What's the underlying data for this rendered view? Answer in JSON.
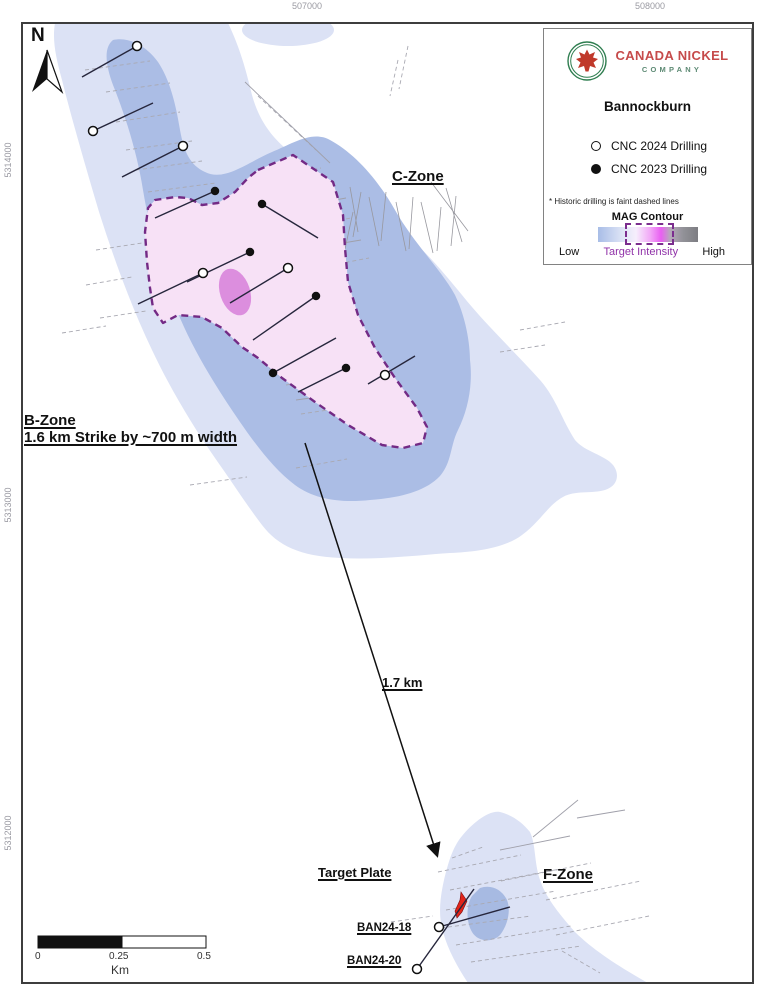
{
  "axes": {
    "top": [
      {
        "label": "507000",
        "x": 307
      },
      {
        "label": "508000",
        "x": 650
      }
    ],
    "left": [
      {
        "label": "5314000",
        "y": 160
      },
      {
        "label": "5313000",
        "y": 505
      },
      {
        "label": "5312000",
        "y": 833
      }
    ]
  },
  "legend": {
    "company_line1": "CANADA NICKEL",
    "company_line2": "COMPANY",
    "project": "Bannockburn",
    "item_2024": "CNC 2024 Drilling",
    "item_2023": "CNC 2023 Drilling",
    "note": "* Historic drilling is faint dashed lines",
    "mag_title": "MAG Contour",
    "mag_low": "Low",
    "mag_target": "Target Intensity",
    "mag_high": "High"
  },
  "labels": {
    "north": "N",
    "c_zone": "C-Zone",
    "b_zone_line1": "B-Zone",
    "b_zone_line2": "1.6 km Strike by ~700 m width",
    "distance": "1.7 km",
    "target_plate": "Target Plate",
    "f_zone": "F-Zone",
    "ban24_18": "BAN24-18",
    "ban24_20": "BAN24-20"
  },
  "scalebar": {
    "t0": "0",
    "t1": "0.25",
    "t2": "0.5",
    "unit": "Km"
  },
  "colors": {
    "mag_low_fill": "#dce2f5",
    "mag_mid_fill": "#abbde5",
    "target_fill": "#f7e1f6",
    "target_outline": "#732a85",
    "target_core": "#d77fd9",
    "plate_red": "#e1251b",
    "brand_red": "#c64b4b",
    "brand_green": "#2e7d4f"
  },
  "map_data": {
    "drilling_2024": [
      {
        "x": 137,
        "y": 46,
        "tx": 82,
        "ty": 77
      },
      {
        "x": 93,
        "y": 131,
        "tx": 153,
        "ty": 103
      },
      {
        "x": 183,
        "y": 146,
        "tx": 122,
        "ty": 177
      },
      {
        "x": 203,
        "y": 273,
        "tx": 138,
        "ty": 304
      },
      {
        "x": 288,
        "y": 268,
        "tx": 230,
        "ty": 303
      },
      {
        "x": 385,
        "y": 375,
        "tx": 415,
        "ty": 356,
        "x2": 368,
        "y2": 384
      },
      {
        "x": 439,
        "y": 927,
        "tx": 510,
        "ty": 907
      },
      {
        "x": 417,
        "y": 969,
        "tx": 474,
        "ty": 889
      }
    ],
    "drilling_2023": [
      {
        "x": 215,
        "y": 191,
        "tx": 155,
        "ty": 218
      },
      {
        "x": 262,
        "y": 204,
        "tx": 318,
        "ty": 238
      },
      {
        "x": 250,
        "y": 252,
        "tx": 187,
        "ty": 282
      },
      {
        "x": 316,
        "y": 296,
        "tx": 253,
        "ty": 340
      },
      {
        "x": 273,
        "y": 373,
        "tx": 336,
        "ty": 338
      },
      {
        "x": 346,
        "y": 368,
        "tx": 298,
        "ty": 392
      }
    ]
  }
}
